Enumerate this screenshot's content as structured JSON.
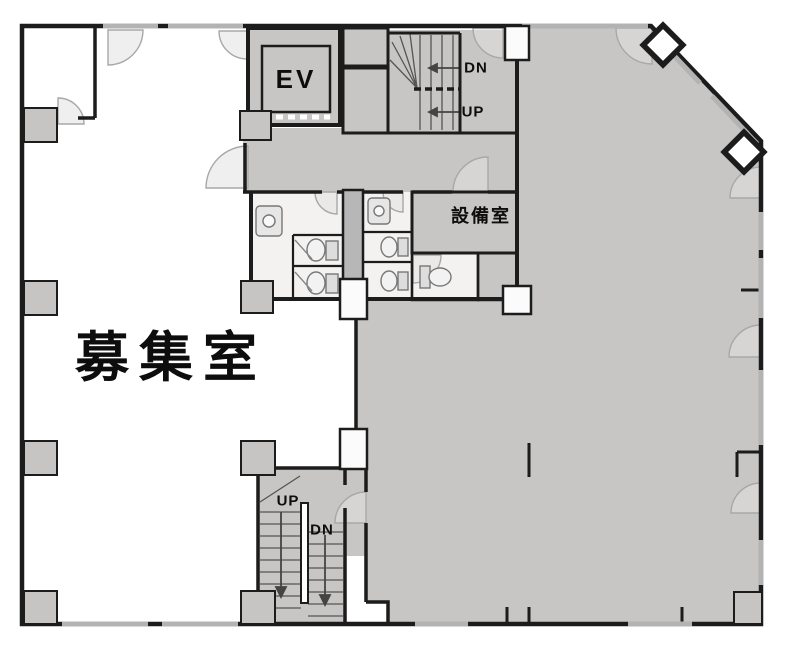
{
  "plan": {
    "labels": {
      "elevator": "EV",
      "upper_stairs_down": "DN",
      "upper_stairs_up": "UP",
      "equipment_room": "設備室",
      "vacancy_room": "募集室",
      "lower_stairs_up": "UP",
      "lower_stairs_down": "DN"
    },
    "colors": {
      "wall": "#1c1c1c",
      "tenant_fill": "#c7c6c4",
      "room_fill": "#f3f2f0",
      "column_fill": "#c6c5c3",
      "arc_stroke": "#a8a8a8",
      "background": "#ffffff"
    }
  }
}
